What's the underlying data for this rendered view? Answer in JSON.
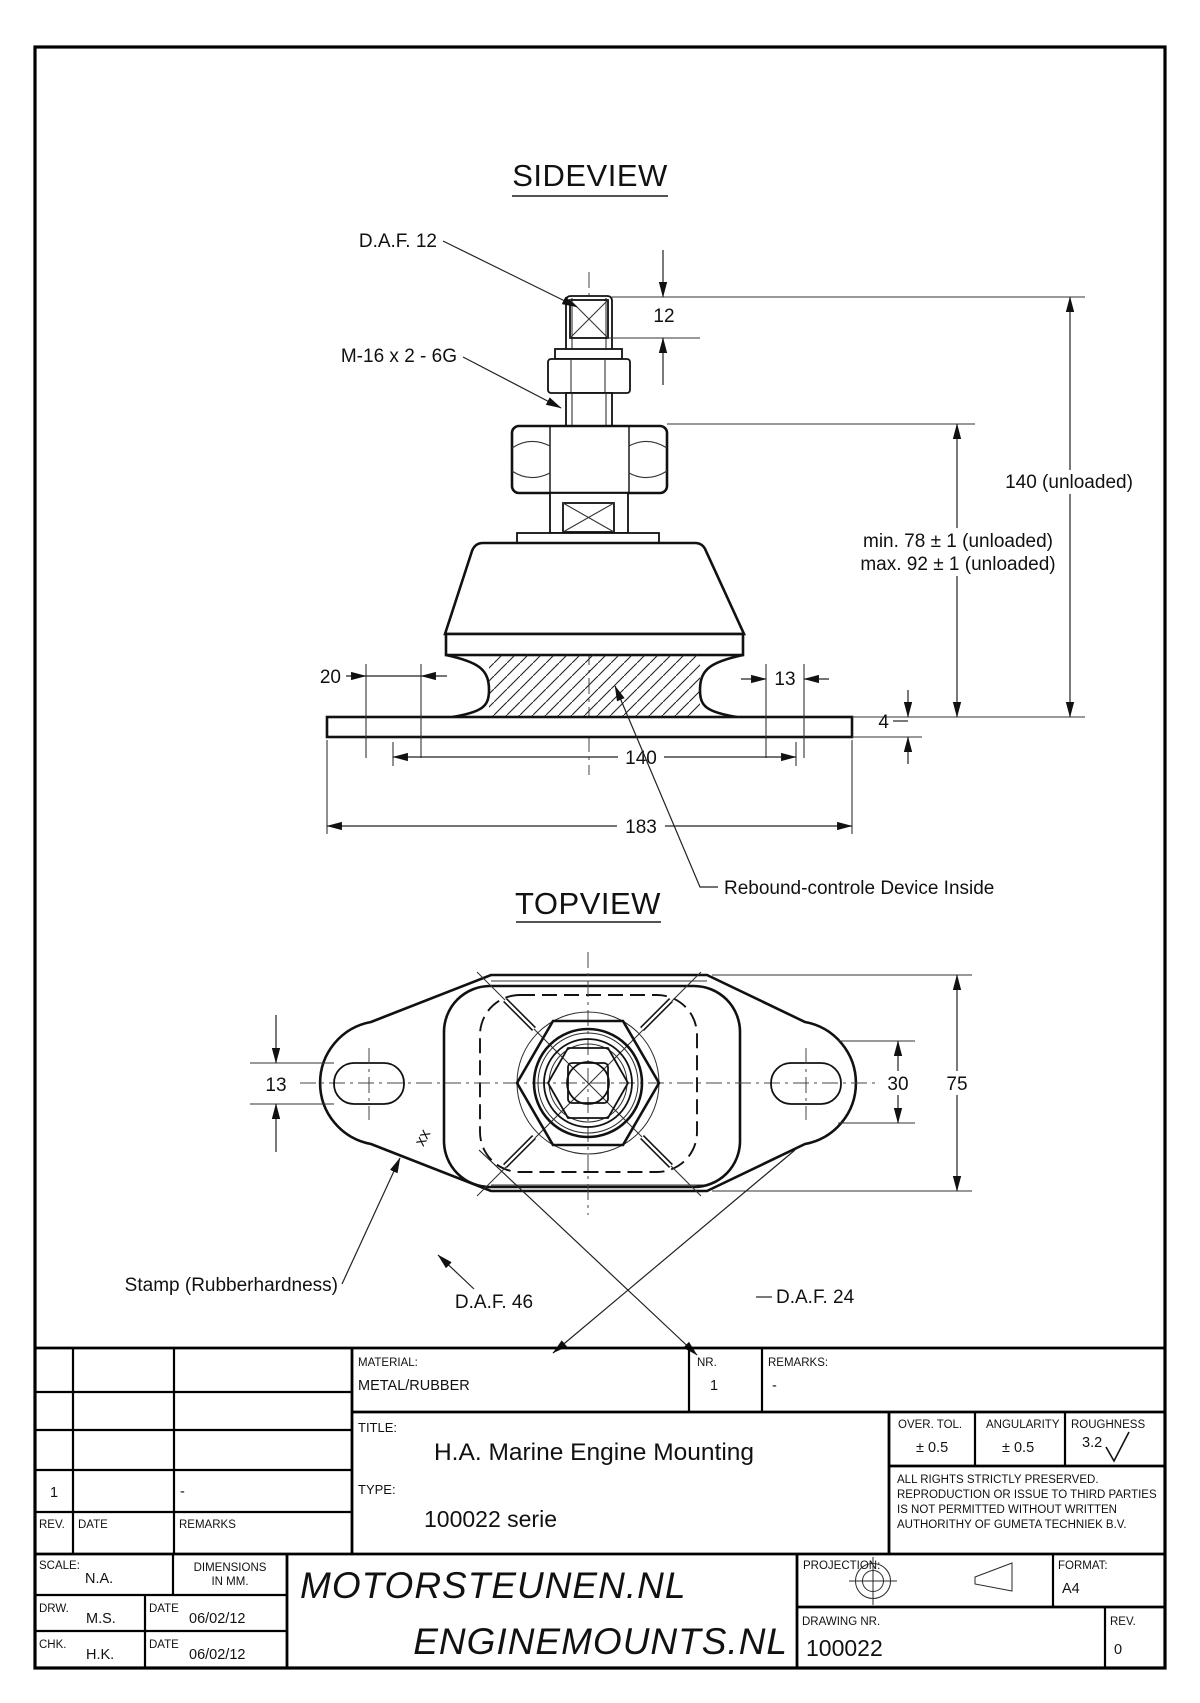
{
  "page": {
    "line_color": "#1a1a1a",
    "background": "#ffffff"
  },
  "sideview": {
    "title": "SIDEVIEW",
    "labels": {
      "daf12": "D.A.F. 12",
      "thread": "M-16 x 2 - 6G",
      "rebound": "Rebound-controle Device Inside"
    },
    "dims": {
      "d12": "12",
      "d140_unloaded": "140 (unloaded)",
      "min78": "min. 78 ± 1 (unloaded)",
      "max92": "max. 92 ± 1 (unloaded)",
      "d20": "20",
      "d13": "13",
      "d4": "4",
      "d140": "140",
      "d183": "183"
    }
  },
  "topview": {
    "title": "TOPVIEW",
    "labels": {
      "stamp": "Stamp (Rubberhardness)",
      "stamp_mark": "xx",
      "daf46": "D.A.F. 46",
      "daf24": "D.A.F. 24"
    },
    "dims": {
      "d13": "13",
      "d30": "30",
      "d75": "75"
    }
  },
  "titleblock": {
    "material_label": "MATERIAL:",
    "material_value": "METAL/RUBBER",
    "nr_label": "NR.",
    "nr_value": "1",
    "remarks_label": "REMARKS:",
    "remarks_value": "-",
    "title_label": "TITLE:",
    "title_value": "H.A. Marine Engine Mounting",
    "type_label": "TYPE:",
    "type_value": "100022 serie",
    "over_tol_label": "OVER. TOL.",
    "over_tol_value": "± 0.5",
    "angularity_label": "ANGULARITY",
    "angularity_value": "± 0.5",
    "roughness_label": "ROUGHNESS",
    "roughness_value": "3.2",
    "rights_lines": [
      "ALL RIGHTS STRICTLY PRESERVED.",
      "REPRODUCTION OR ISSUE TO THIRD PARTIES",
      "IS NOT PERMITTED WITHOUT WRITTEN",
      "AUTHORITHY OF GUMETA TECHNIEK B.V."
    ],
    "rev_table": {
      "rev_header": "REV.",
      "date_header": "DATE",
      "remarks_header": "REMARKS",
      "row_rev": "1",
      "row_remarks": "-"
    },
    "scale_label": "SCALE:",
    "scale_value": "N.A.",
    "dimensions_label_1": "DIMENSIONS",
    "dimensions_label_2": "IN MM.",
    "drw_label": "DRW.",
    "drw_value": "M.S.",
    "drw_date_label": "DATE",
    "drw_date_value": "06/02/12",
    "chk_label": "CHK.",
    "chk_value": "H.K.",
    "chk_date_label": "DATE",
    "chk_date_value": "06/02/12",
    "brand_line1": "MOTORSTEUNEN.NL",
    "brand_line2": "ENGINEMOUNTS.NL",
    "projection_label": "PROJECTION:",
    "format_label": "FORMAT:",
    "format_value": "A4",
    "drawing_nr_label": "DRAWING NR.",
    "drawing_nr_value": "100022",
    "rev_label": "REV.",
    "rev_value": "0"
  }
}
